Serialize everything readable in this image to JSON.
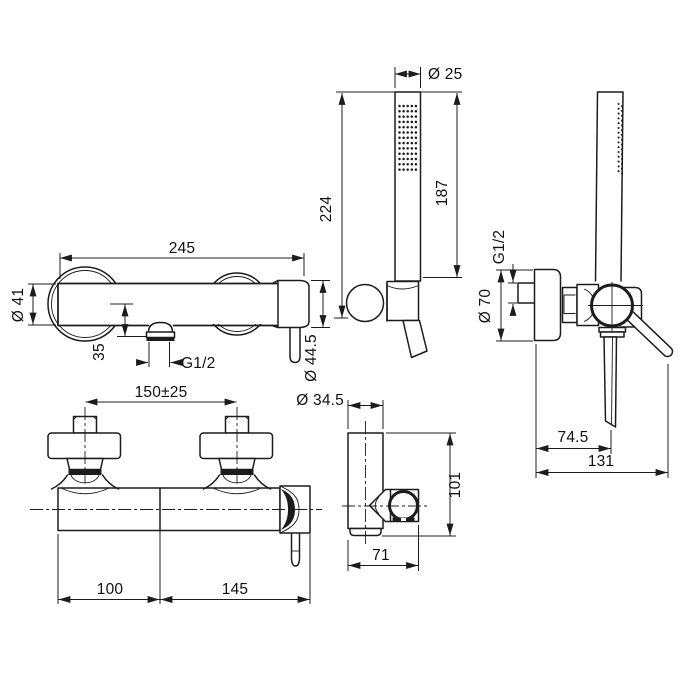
{
  "dims": {
    "handshower_diameter": "Ø 25",
    "handshower_length": "187",
    "handshower_total_length": "224",
    "body_length": "245",
    "body_diameter": "Ø 41",
    "outlet_offset": "35",
    "outlet_thread": "G1/2",
    "endcap_diameter": "Ø 44.5",
    "inlet_spacing": "150±25",
    "inlet_left_span": "100",
    "inlet_right_span": "145",
    "holder_diameter": "Ø 34.5",
    "holder_height": "101",
    "holder_depth": "71",
    "inlet_thread": "G1/2",
    "flange_diameter": "Ø 70",
    "depth_to_hose": "74.5",
    "total_depth": "131"
  }
}
